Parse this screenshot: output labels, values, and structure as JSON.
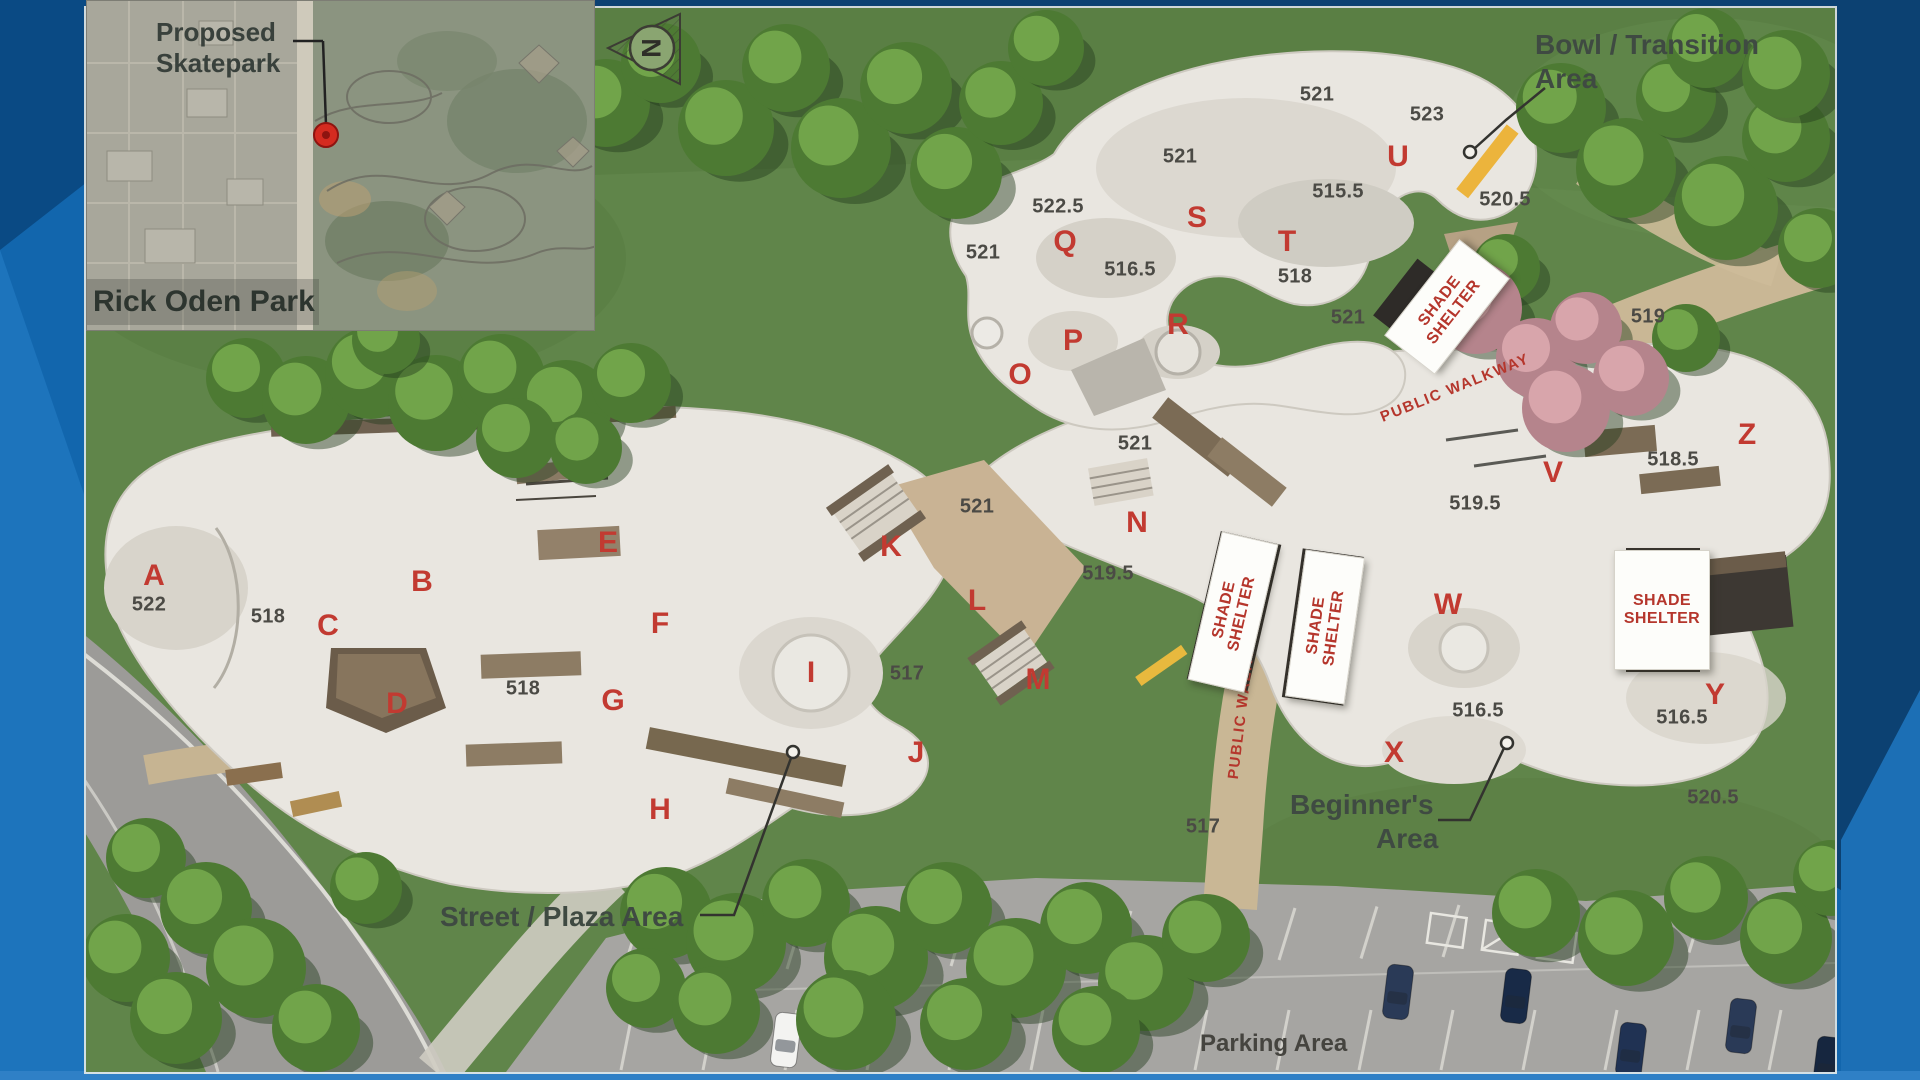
{
  "colors": {
    "frame_blue": "#1266ad",
    "frame_dark": "#0b3e6c",
    "frame_light": "#2b7dc3",
    "area_letter_red": "#c23a31",
    "shelter_text_red": "#b5362c",
    "annotation_green": "#3f4a42",
    "elevation_gray": "#4b4a45"
  },
  "inset_map": {
    "callout_line1": "Proposed",
    "callout_line2": "Skatepark",
    "park_name": "Rick Oden Park"
  },
  "north_arrow_letter": "N",
  "annotations": {
    "bowl_line1": "Bowl / Transition",
    "bowl_line2": "Area",
    "street": "Street / Plaza Area",
    "beginners_line1": "Beginner's",
    "beginners_line2": "Area",
    "parking": "Parking Area"
  },
  "area_letters": [
    {
      "t": "A",
      "x": 154,
      "y": 576
    },
    {
      "t": "B",
      "x": 422,
      "y": 582
    },
    {
      "t": "C",
      "x": 328,
      "y": 626
    },
    {
      "t": "D",
      "x": 397,
      "y": 704
    },
    {
      "t": "E",
      "x": 608,
      "y": 543
    },
    {
      "t": "F",
      "x": 660,
      "y": 624
    },
    {
      "t": "G",
      "x": 613,
      "y": 701
    },
    {
      "t": "H",
      "x": 660,
      "y": 810
    },
    {
      "t": "I",
      "x": 811,
      "y": 673
    },
    {
      "t": "J",
      "x": 916,
      "y": 753
    },
    {
      "t": "K",
      "x": 891,
      "y": 547
    },
    {
      "t": "L",
      "x": 977,
      "y": 601
    },
    {
      "t": "M",
      "x": 1038,
      "y": 680
    },
    {
      "t": "N",
      "x": 1137,
      "y": 523
    },
    {
      "t": "O",
      "x": 1020,
      "y": 375
    },
    {
      "t": "P",
      "x": 1073,
      "y": 341
    },
    {
      "t": "Q",
      "x": 1065,
      "y": 242
    },
    {
      "t": "R",
      "x": 1178,
      "y": 325
    },
    {
      "t": "S",
      "x": 1197,
      "y": 218
    },
    {
      "t": "T",
      "x": 1287,
      "y": 242
    },
    {
      "t": "U",
      "x": 1398,
      "y": 157
    },
    {
      "t": "V",
      "x": 1553,
      "y": 473
    },
    {
      "t": "W",
      "x": 1448,
      "y": 605
    },
    {
      "t": "X",
      "x": 1394,
      "y": 753
    },
    {
      "t": "Y",
      "x": 1715,
      "y": 695
    },
    {
      "t": "Z",
      "x": 1747,
      "y": 435
    }
  ],
  "elevations": [
    {
      "t": "522",
      "x": 149,
      "y": 605
    },
    {
      "t": "518",
      "x": 268,
      "y": 617
    },
    {
      "t": "518",
      "x": 523,
      "y": 689
    },
    {
      "t": "517",
      "x": 907,
      "y": 674
    },
    {
      "t": "521",
      "x": 977,
      "y": 507
    },
    {
      "t": "521",
      "x": 1135,
      "y": 444
    },
    {
      "t": "519.5",
      "x": 1108,
      "y": 574
    },
    {
      "t": "521",
      "x": 983,
      "y": 253
    },
    {
      "t": "522.5",
      "x": 1058,
      "y": 207
    },
    {
      "t": "516.5",
      "x": 1130,
      "y": 270
    },
    {
      "t": "521",
      "x": 1180,
      "y": 157
    },
    {
      "t": "521",
      "x": 1317,
      "y": 95
    },
    {
      "t": "523",
      "x": 1427,
      "y": 115
    },
    {
      "t": "515.5",
      "x": 1338,
      "y": 192
    },
    {
      "t": "518",
      "x": 1295,
      "y": 277
    },
    {
      "t": "520.5",
      "x": 1505,
      "y": 200
    },
    {
      "t": "521",
      "x": 1348,
      "y": 318
    },
    {
      "t": "519",
      "x": 1648,
      "y": 317
    },
    {
      "t": "519.5",
      "x": 1475,
      "y": 504
    },
    {
      "t": "518.5",
      "x": 1673,
      "y": 460
    },
    {
      "t": "516.5",
      "x": 1478,
      "y": 711
    },
    {
      "t": "516.5",
      "x": 1682,
      "y": 718
    },
    {
      "t": "520.5",
      "x": 1713,
      "y": 798
    },
    {
      "t": "517",
      "x": 1203,
      "y": 827
    }
  ],
  "shade_shelters": {
    "label_line1": "SHADE",
    "label_line2": "SHELTER",
    "positions": [
      {
        "x": 1447,
        "y": 307,
        "w": 120,
        "h": 62,
        "rot": -52,
        "tall": false
      },
      {
        "x": 1233,
        "y": 612,
        "w": 56,
        "h": 150,
        "rot": 13,
        "tall": true
      },
      {
        "x": 1325,
        "y": 627,
        "w": 58,
        "h": 146,
        "rot": 8,
        "tall": true
      },
      {
        "x": 1662,
        "y": 610,
        "w": 94,
        "h": 118,
        "rot": 0,
        "tall": false
      }
    ]
  },
  "public_walkways": {
    "label": "PUBLIC WALKWAY",
    "positions": [
      {
        "x": 1455,
        "y": 388,
        "rot": -22
      },
      {
        "x": 1243,
        "y": 700,
        "rot": -83
      }
    ]
  }
}
